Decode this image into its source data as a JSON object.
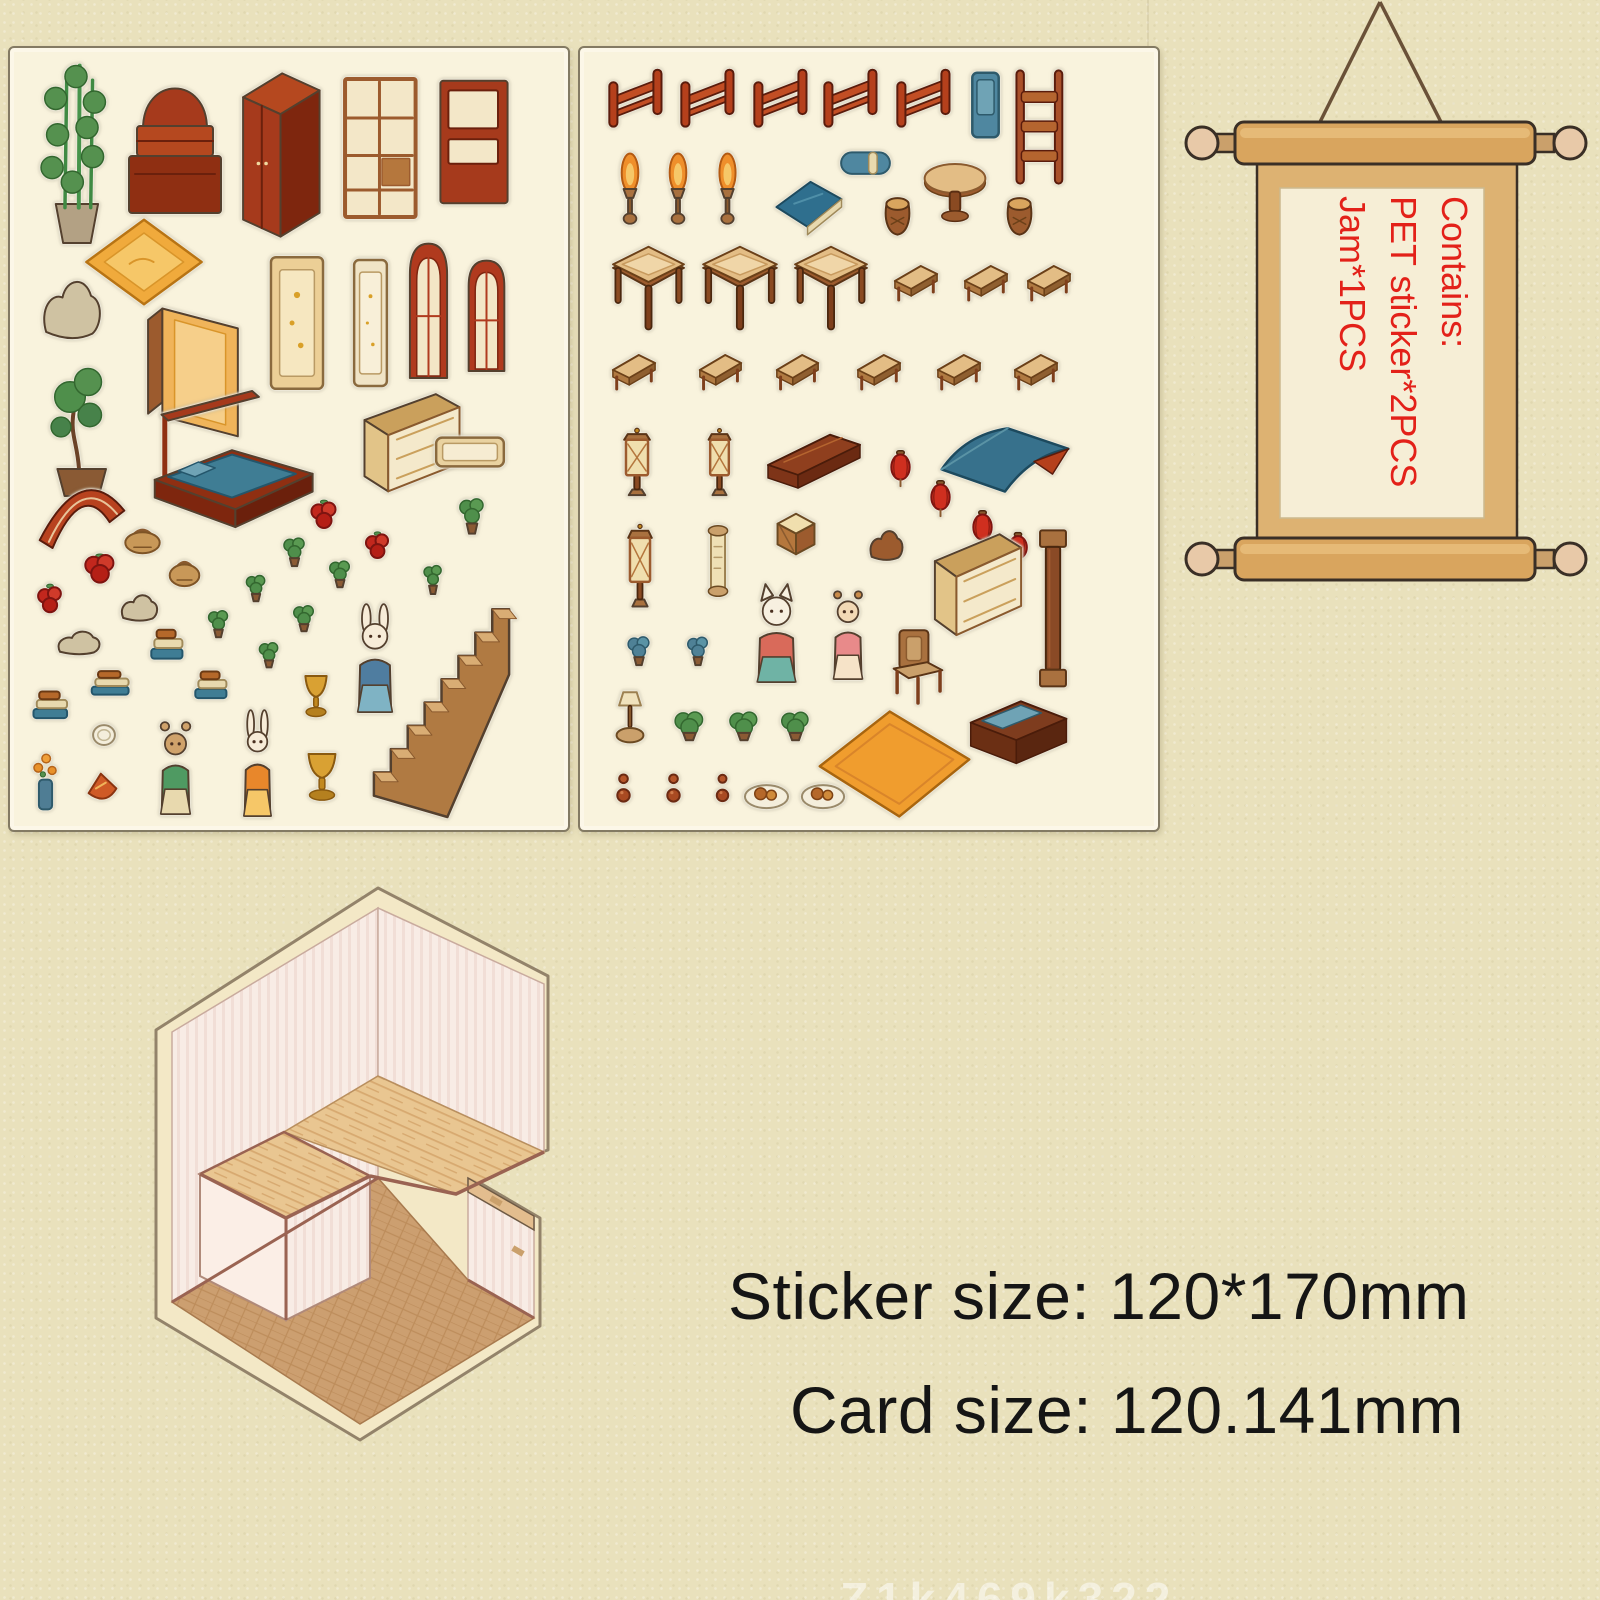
{
  "colors": {
    "accent_red": "#e32119",
    "ink": "#151515",
    "paper": "#e9e1bc",
    "sheet": "#f9f3dd"
  },
  "scroll": {
    "lines": [
      "Contains:",
      "PET sticker*2PCS",
      "Jam*1PCS"
    ]
  },
  "size_text": {
    "line1": "Sticker size: 120*170mm",
    "line2": "Card size: 120.141mm"
  },
  "watermark": "Z1k469k322",
  "sheets": [
    {
      "name": "sticker-sheet-1",
      "x": 8,
      "y": 46,
      "w": 558,
      "h": 782,
      "stickers": [
        [
          "bamboo-plant",
          "bamboo",
          20,
          14,
          92,
          182
        ],
        [
          "altar-cabinet",
          "cabinetStep",
          115,
          18,
          100,
          150
        ],
        [
          "red-wardrobe",
          "wardrobe",
          228,
          22,
          85,
          170
        ],
        [
          "lattice-shelf",
          "shelfLattice",
          330,
          25,
          84,
          150
        ],
        [
          "open-shelf",
          "shelfOpen",
          424,
          26,
          80,
          136
        ],
        [
          "diamond-rug",
          "rugDiamond",
          74,
          170,
          120,
          88
        ],
        [
          "garden-rock",
          "rock",
          28,
          220,
          68,
          82
        ],
        [
          "hanging-cloth",
          "hangCloth",
          134,
          252,
          102,
          142
        ],
        [
          "gold-screen",
          "screenGold",
          256,
          205,
          62,
          140
        ],
        [
          "pale-screen",
          "screenPale",
          341,
          208,
          39,
          134
        ],
        [
          "arch-window-1",
          "archWindow",
          394,
          190,
          49,
          142
        ],
        [
          "arch-window-2",
          "archWindow",
          453,
          208,
          47,
          117
        ],
        [
          "bonsai-tree",
          "bonsai",
          24,
          304,
          90,
          150
        ],
        [
          "fan-window",
          "fanWindow",
          26,
          420,
          92,
          82
        ],
        [
          "canopy-bed",
          "bedCanopy",
          138,
          340,
          168,
          148
        ],
        [
          "lattice-window",
          "windowBig",
          348,
          344,
          108,
          108
        ],
        [
          "plaque",
          "plaque",
          424,
          380,
          72,
          48
        ],
        [
          "red-fruit-1",
          "fruitRed",
          296,
          448,
          36,
          37
        ],
        [
          "red-fruit-2",
          "fruitRed",
          351,
          480,
          33,
          35
        ],
        [
          "red-fruit-3",
          "fruitRed",
          69,
          502,
          42,
          36
        ],
        [
          "red-fruit-4",
          "fruitRed",
          23,
          532,
          34,
          38
        ],
        [
          "potted-plant-1",
          "plantSmall",
          443,
          440,
          38,
          48
        ],
        [
          "potted-plant-2",
          "plantSmall",
          268,
          482,
          33,
          38
        ],
        [
          "potted-plant-3",
          "plantSmall",
          314,
          506,
          32,
          35
        ],
        [
          "potted-plant-4",
          "plantSmall",
          231,
          520,
          30,
          35
        ],
        [
          "potted-plant-5",
          "plantSmall",
          193,
          555,
          31,
          36
        ],
        [
          "potted-plant-6",
          "plantSmall",
          278,
          551,
          32,
          34
        ],
        [
          "potted-plant-7",
          "plantSmall",
          244,
          588,
          30,
          33
        ],
        [
          "potted-plant-8",
          "plantSmall",
          409,
          508,
          28,
          40
        ],
        [
          "basket-1",
          "basket",
          111,
          473,
          43,
          35
        ],
        [
          "basket-2",
          "basket",
          156,
          505,
          37,
          36
        ],
        [
          "small-rock-1",
          "rock",
          108,
          541,
          43,
          37
        ],
        [
          "small-rock-2",
          "rock",
          44,
          578,
          50,
          33
        ],
        [
          "book-stack-1",
          "bookStack",
          139,
          578,
          38,
          38
        ],
        [
          "book-stack-2",
          "bookStack",
          183,
          620,
          38,
          35
        ],
        [
          "book-stack-3",
          "bookStack",
          79,
          620,
          45,
          31
        ],
        [
          "book-stack-4",
          "bookStack",
          21,
          640,
          41,
          35
        ],
        [
          "plate",
          "plate",
          81,
          670,
          26,
          31
        ],
        [
          "flower-vase",
          "flowerVase",
          19,
          700,
          33,
          66
        ],
        [
          "red-food",
          "foodRed",
          76,
          721,
          33,
          39
        ],
        [
          "bear-figure",
          "figureBear",
          139,
          665,
          53,
          103
        ],
        [
          "rabbit-figure-orange",
          "figureRabbitOrange",
          223,
          661,
          49,
          109
        ],
        [
          "rabbit-figure-blue",
          "figureRabbitBlue",
          334,
          555,
          62,
          111
        ],
        [
          "gold-trophy-1",
          "trophyGold",
          287,
          621,
          38,
          50
        ],
        [
          "gold-trophy-2",
          "trophyGold",
          288,
          698,
          48,
          57
        ],
        [
          "staircase",
          "stairs",
          358,
          538,
          147,
          233
        ]
      ]
    },
    {
      "name": "sticker-sheet-2",
      "x": 578,
      "y": 46,
      "w": 578,
      "h": 782,
      "stickers": [
        [
          "railing-1",
          "railing",
          27,
          18,
          58,
          74
        ],
        [
          "railing-2",
          "railing",
          99,
          18,
          58,
          74
        ],
        [
          "railing-3",
          "railing",
          172,
          18,
          58,
          74
        ],
        [
          "railing-4",
          "railing",
          242,
          18,
          58,
          74
        ],
        [
          "railing-5",
          "railing",
          315,
          18,
          58,
          74
        ],
        [
          "blue-door",
          "doorBlue",
          389,
          22,
          33,
          70
        ],
        [
          "ladder-rack",
          "ladderRack",
          429,
          20,
          62,
          118
        ],
        [
          "torch-lamp-1",
          "torch",
          34,
          104,
          32,
          74
        ],
        [
          "torch-lamp-2",
          "torch",
          82,
          104,
          32,
          74
        ],
        [
          "torch-lamp-3",
          "torch",
          132,
          104,
          31,
          74
        ],
        [
          "blue-blanket",
          "blanketBlue",
          192,
          126,
          74,
          66
        ],
        [
          "bolster-pillow",
          "bolster",
          259,
          97,
          53,
          37
        ],
        [
          "round-table",
          "roundTable",
          342,
          112,
          66,
          66
        ],
        [
          "drum-stool-1",
          "drumStool",
          302,
          147,
          31,
          45
        ],
        [
          "drum-stool-2",
          "drumStool",
          424,
          147,
          31,
          45
        ],
        [
          "square-table-1",
          "squareTable",
          30,
          197,
          77,
          88
        ],
        [
          "square-table-2",
          "squareTable",
          120,
          197,
          80,
          88
        ],
        [
          "square-table-3",
          "squareTable",
          212,
          197,
          78,
          88
        ],
        [
          "bench-1",
          "bench",
          312,
          212,
          48,
          50
        ],
        [
          "bench-2",
          "bench",
          382,
          212,
          48,
          50
        ],
        [
          "bench-3",
          "bench",
          445,
          212,
          48,
          50
        ],
        [
          "bench-4",
          "bench",
          30,
          301,
          48,
          50
        ],
        [
          "bench-5",
          "bench",
          117,
          301,
          47,
          50
        ],
        [
          "bench-6",
          "bench",
          194,
          301,
          47,
          50
        ],
        [
          "bench-7",
          "bench",
          275,
          301,
          48,
          50
        ],
        [
          "bench-8",
          "bench",
          355,
          301,
          48,
          50
        ],
        [
          "bench-9",
          "bench",
          432,
          301,
          48,
          50
        ],
        [
          "stand-lantern-1",
          "standLantern",
          34,
          379,
          46,
          71
        ],
        [
          "stand-lantern-2",
          "standLantern",
          120,
          379,
          39,
          71
        ],
        [
          "shelf-board",
          "shelfBoard",
          184,
          381,
          100,
          72
        ],
        [
          "red-lantern-1",
          "lanternRed",
          307,
          402,
          27,
          38
        ],
        [
          "red-lantern-2",
          "lanternRed",
          347,
          432,
          27,
          38
        ],
        [
          "red-lantern-3",
          "lanternRed",
          389,
          462,
          27,
          38
        ],
        [
          "red-lantern-4",
          "lanternRed",
          425,
          484,
          26,
          34
        ],
        [
          "blue-roof",
          "roofBlue",
          359,
          374,
          132,
          79
        ],
        [
          "stand-lantern-3",
          "standLantern",
          39,
          474,
          42,
          88
        ],
        [
          "scroll-piece",
          "scrollItem",
          122,
          477,
          32,
          72
        ],
        [
          "crate",
          "crate",
          195,
          464,
          42,
          45
        ],
        [
          "wood-joint",
          "jointPiece",
          287,
          476,
          39,
          42
        ],
        [
          "big-window",
          "windowBig",
          349,
          484,
          98,
          112
        ],
        [
          "pillar",
          "pillar",
          455,
          479,
          36,
          166
        ],
        [
          "cat-figure",
          "figureCat",
          162,
          532,
          69,
          104
        ],
        [
          "girl-figure",
          "figureGirl",
          242,
          534,
          52,
          99
        ],
        [
          "blue-plant-1",
          "plantBlue",
          42,
          581,
          34,
          38
        ],
        [
          "blue-plant-2",
          "plantBlue",
          102,
          581,
          32,
          38
        ],
        [
          "armchair",
          "chair",
          309,
          579,
          58,
          80
        ],
        [
          "incense-stand",
          "incense",
          29,
          641,
          42,
          55
        ],
        [
          "green-plant-1",
          "plantSmall",
          87,
          659,
          45,
          35
        ],
        [
          "green-plant-2",
          "plantSmall",
          142,
          659,
          44,
          35
        ],
        [
          "green-plant-3",
          "plantSmall",
          194,
          659,
          43,
          35
        ],
        [
          "orange-rug",
          "rugOrange",
          235,
          659,
          159,
          114
        ],
        [
          "cushion-bench",
          "benchCushion",
          377,
          632,
          114,
          97
        ],
        [
          "gourd-1",
          "gourd",
          30,
          717,
          27,
          46
        ],
        [
          "gourd-2",
          "gourd",
          80,
          717,
          27,
          46
        ],
        [
          "gourd-3",
          "gourd",
          130,
          717,
          25,
          46
        ],
        [
          "food-plate-1",
          "foodPlate",
          162,
          727,
          49,
          36
        ],
        [
          "food-plate-2",
          "foodPlate",
          219,
          727,
          48,
          36
        ]
      ]
    }
  ]
}
